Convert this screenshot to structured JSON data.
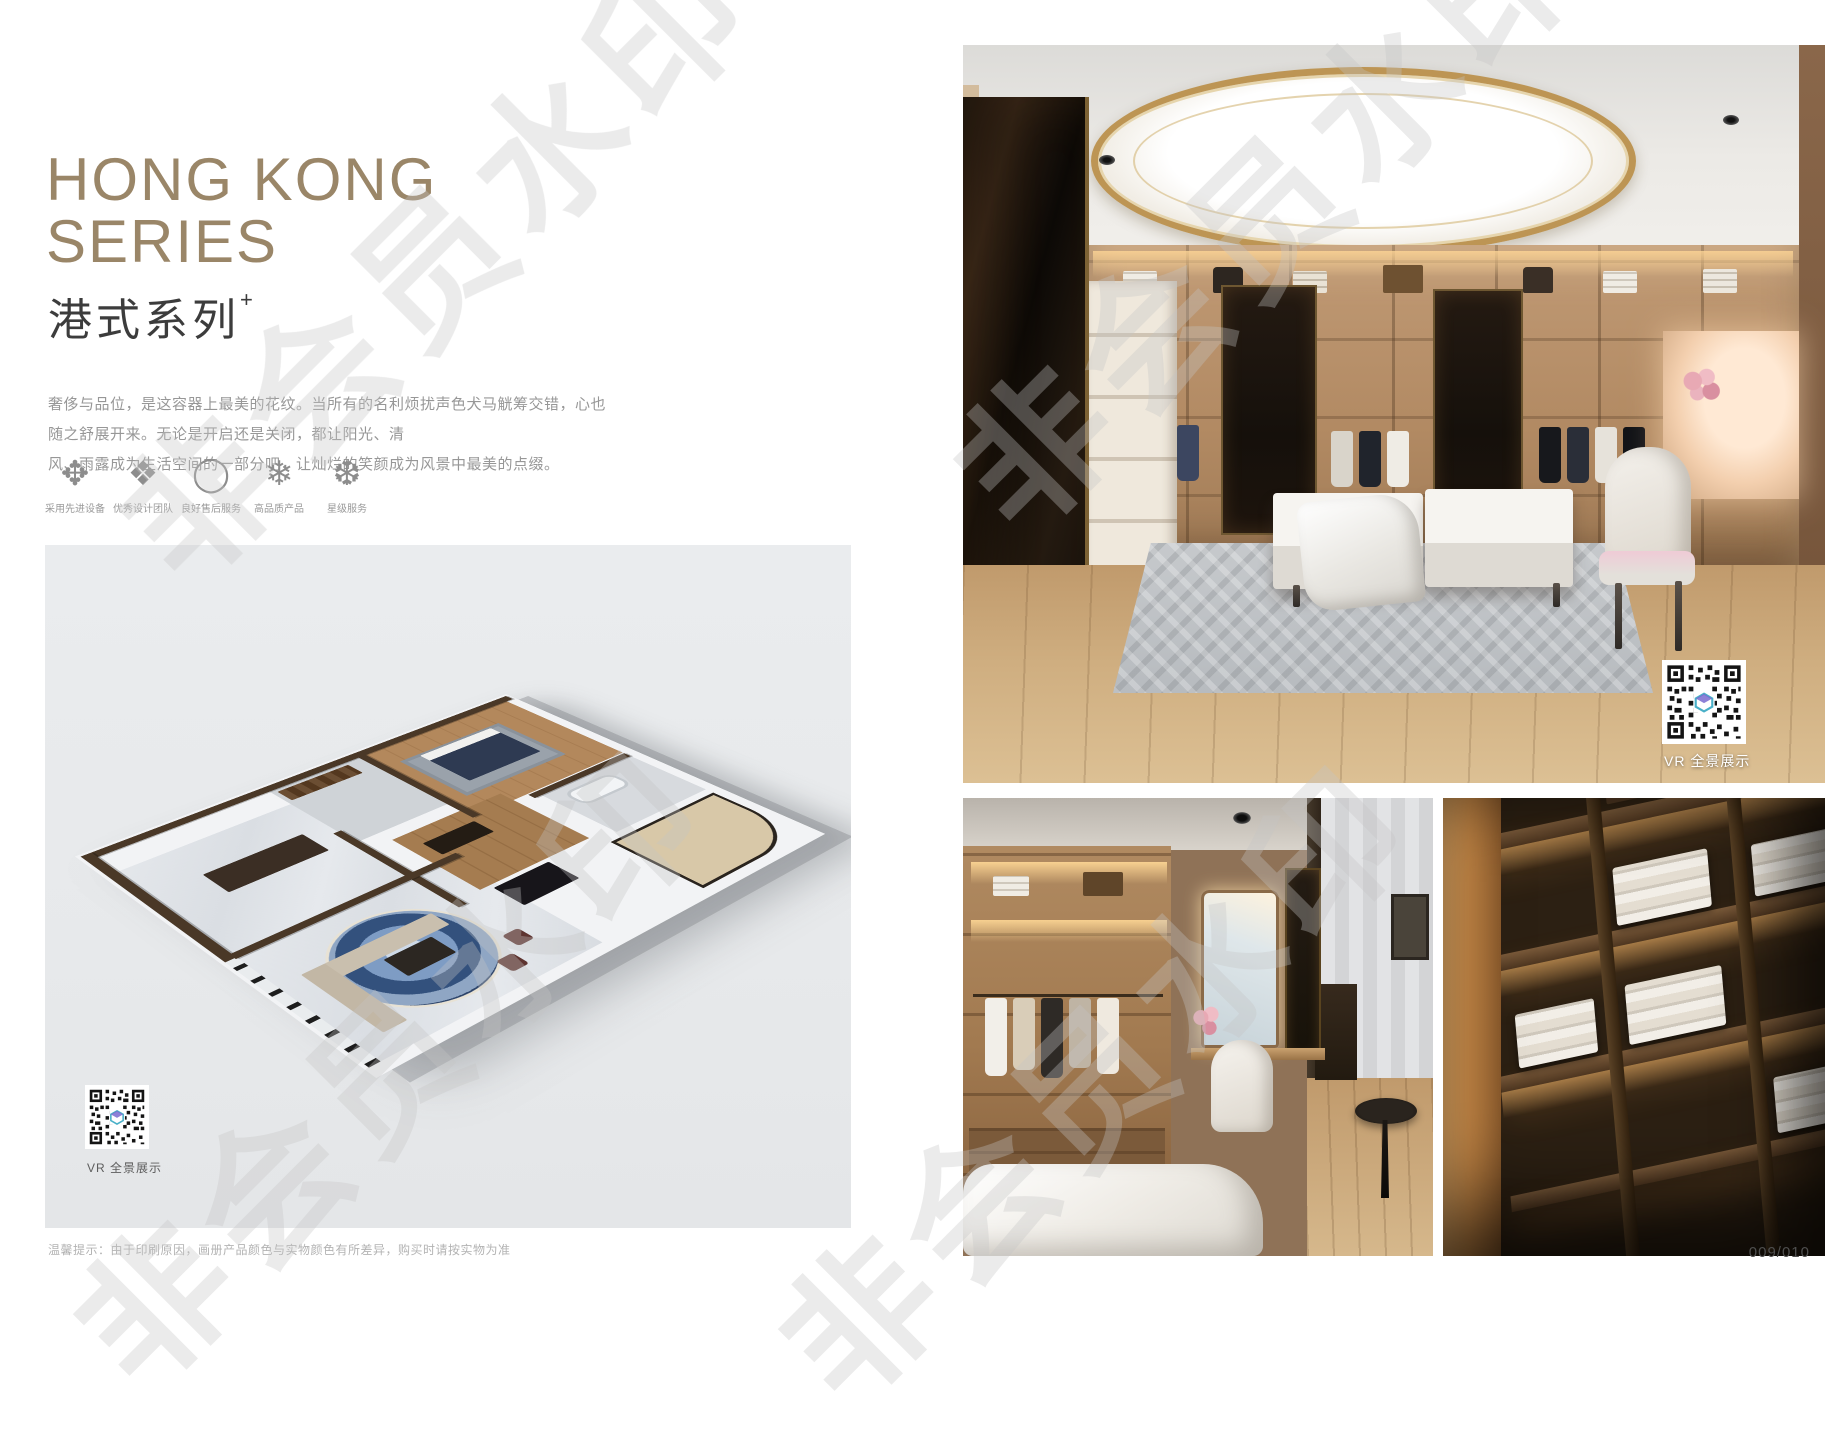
{
  "page": {
    "title_line1": "HONG KONG",
    "title_line2": "SERIES",
    "subtitle": "港式系列",
    "subtitle_mark": "+",
    "description_line1": "奢侈与品位，是这容器上最美的花纹。当所有的名利烦扰声色犬马觥筹交错，心也随之舒展开来。无论是开启还是关闭，都让阳光、清",
    "description_line2": "风、雨露成为生活空间的一部分吧，让灿烂的笑颜成为风景中最美的点缀。",
    "disclaimer": "温馨提示：由于印刷原因，画册产品颜色与实物颜色有所差异，购买时请按实物为准",
    "page_number": "009/010"
  },
  "features": [
    {
      "icon": "ornament-cross-icon",
      "glyph": "✥",
      "label": "采用先进设备"
    },
    {
      "icon": "ornament-diamond-icon",
      "glyph": "❖",
      "label": "优秀设计团队"
    },
    {
      "icon": "ring-icon",
      "glyph": "◯",
      "label": "良好售后服务"
    },
    {
      "icon": "snowflake-icon",
      "glyph": "❄",
      "label": "高品质产品"
    },
    {
      "icon": "snowflake-dot-icon",
      "glyph": "❆",
      "label": "星级服务"
    }
  ],
  "vr": {
    "floorplan_label": "VR 全景展示",
    "main_label": "VR 全景展示"
  },
  "watermark": {
    "text": "非会员水印"
  },
  "colors": {
    "accent_bronze": "#9a8668",
    "gold_ring": "#bd9554",
    "text_dark": "#3c3c3c",
    "text_gray": "#979797",
    "figure_bg": "#e9ebed"
  }
}
